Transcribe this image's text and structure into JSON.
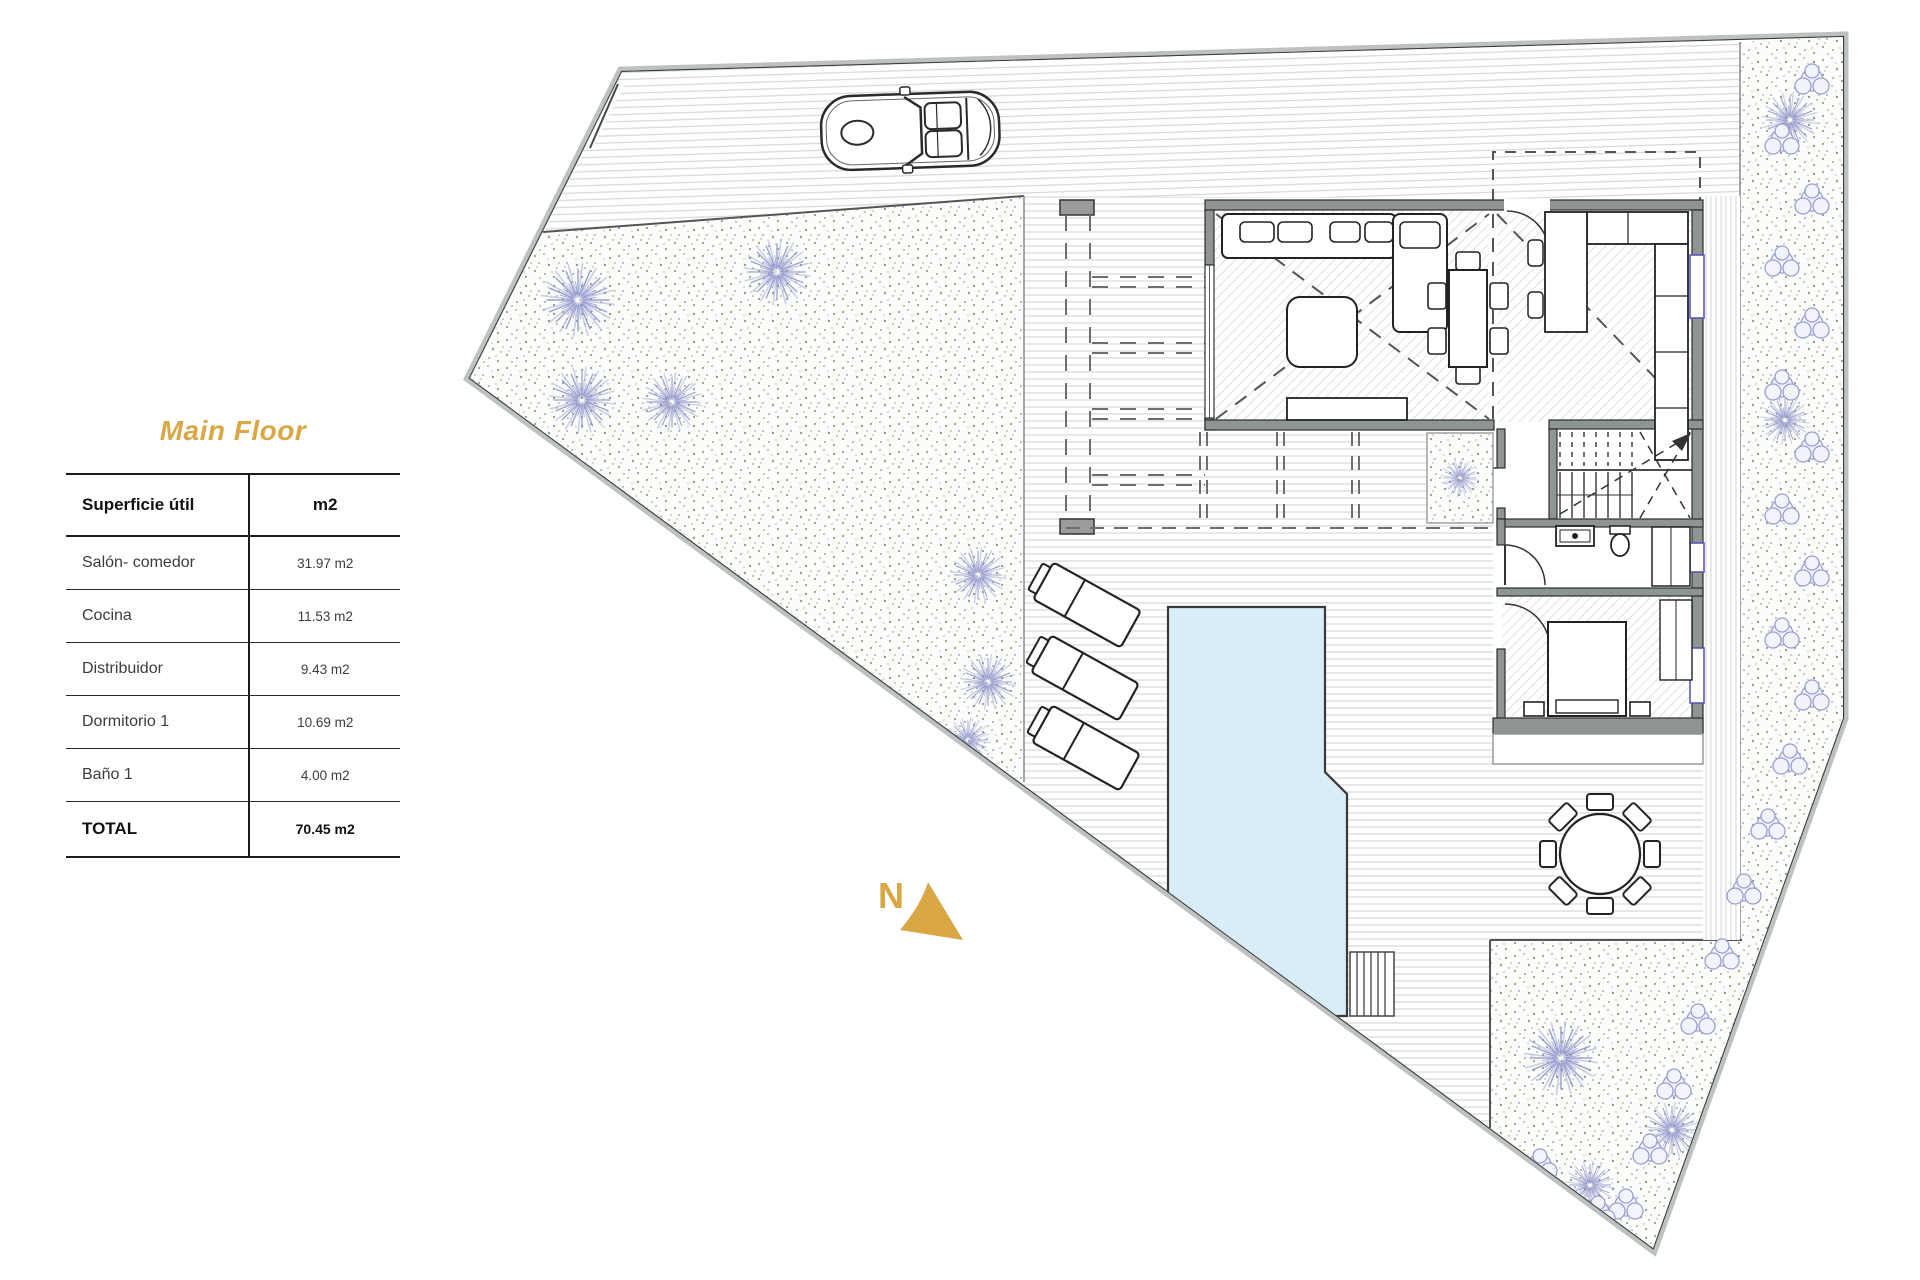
{
  "panel": {
    "title": "Main Floor",
    "table": {
      "header": {
        "label": "Superficie útil",
        "value": "m2"
      },
      "rows": [
        {
          "label": "Salón- comedor",
          "value": "31.97 m2"
        },
        {
          "label": "Cocina",
          "value": "11.53 m2"
        },
        {
          "label": "Distribuidor",
          "value": "9.43 m2"
        },
        {
          "label": "Dormitorio 1",
          "value": "10.69 m2"
        },
        {
          "label": "Baño 1",
          "value": "4.00 m2"
        }
      ],
      "total": {
        "label": "TOTAL",
        "value": "70.45 m2"
      }
    }
  },
  "plan": {
    "north_label": "N",
    "colors": {
      "accent_gold": "#D9A845",
      "pool_water": "#D9EDF8",
      "tree_foliage": "#9298CC",
      "wall_gray": "#8F9595",
      "boundary_band": "#BDC1C1",
      "garden_dot_green": "#8FA18F",
      "deck_stripe": "#D9D9D9"
    },
    "elements": [
      "site-boundary",
      "driveway",
      "car",
      "gate",
      "garden-left",
      "garden-right",
      "trees",
      "hedge-bushes",
      "pergola",
      "house",
      "living-room",
      "sofa",
      "coffee-table",
      "dining-table",
      "sideboard",
      "kitchen",
      "kitchen-island",
      "stairs",
      "bathroom",
      "bedroom",
      "bed",
      "pool",
      "pool-steps",
      "sun-loungers",
      "outdoor-round-table",
      "north-arrow"
    ]
  }
}
